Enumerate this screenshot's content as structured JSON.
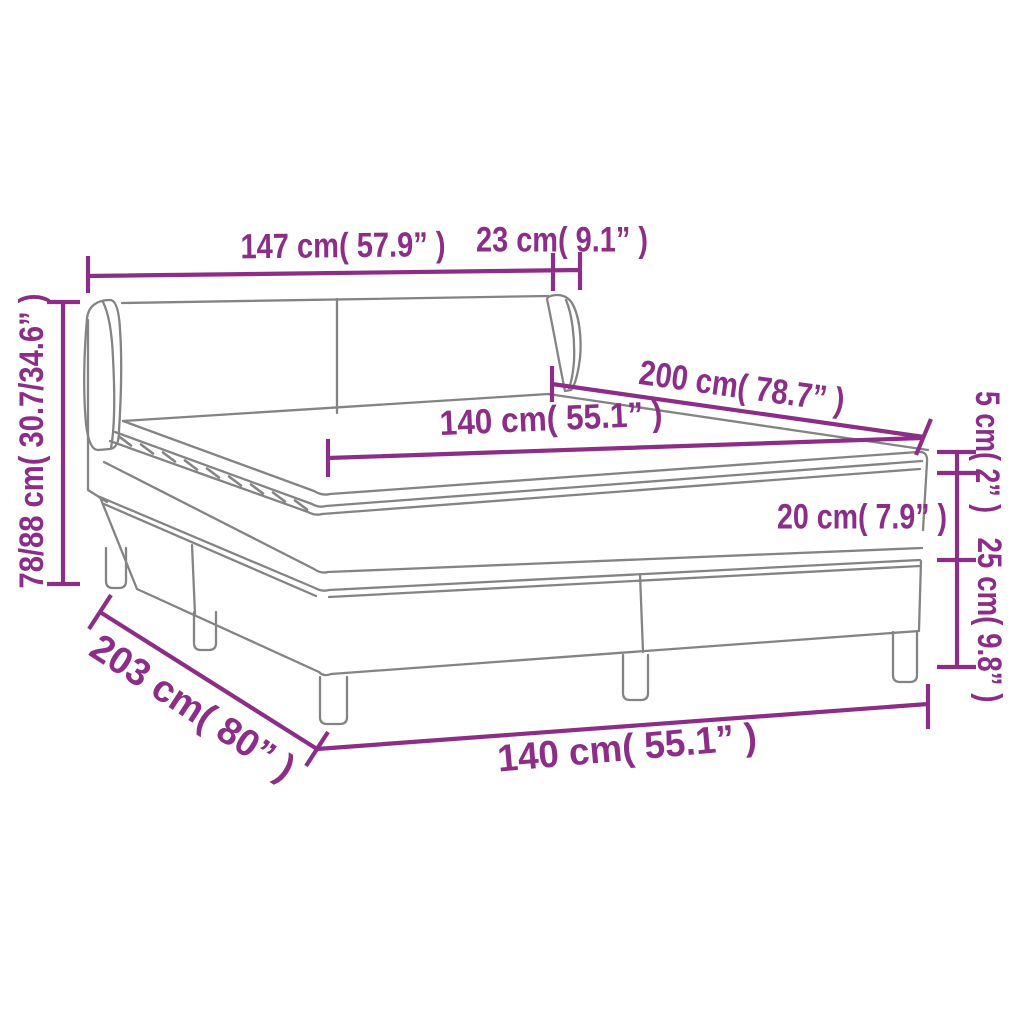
{
  "diagram": {
    "kind": "product dimension diagram",
    "subject": "box spring bed with winged headboard, mattress and topper",
    "colors": {
      "accent": "#8C2E87",
      "drawing_line": "#848484",
      "background": "#FFFFFF"
    },
    "units": {
      "primary": "cm",
      "secondary": "inches"
    }
  },
  "dims": {
    "headboard_width": {
      "label": "147 cm( 57.9” )",
      "value_cm": "147",
      "value_in": "57.9"
    },
    "wing_depth": {
      "label": "23 cm( 9.1” )",
      "value_cm": "23",
      "value_in": "9.1"
    },
    "headboard_height": {
      "label": "78/88 cm( 30.7/34.6” )",
      "value_cm": "78/88",
      "value_in": "30.7/34.6"
    },
    "bed_length": {
      "label": "200 cm( 78.7” )",
      "value_cm": "200",
      "value_in": "78.7"
    },
    "mattress_width": {
      "label": "140 cm( 55.1” )",
      "value_cm": "140",
      "value_in": "55.1"
    },
    "topper_thickness": {
      "label": "5 cm( 2” )",
      "value_cm": "5",
      "value_in": "2"
    },
    "mattress_thickness": {
      "label": "20 cm( 7.9” )",
      "value_cm": "20",
      "value_in": "7.9"
    },
    "base_height": {
      "label": "25 cm( 9.8” )",
      "value_cm": "25",
      "value_in": "9.8"
    },
    "base_length": {
      "label": "203 cm( 80” )",
      "value_cm": "203",
      "value_in": "80"
    },
    "base_width": {
      "label": "140 cm( 55.1” )",
      "value_cm": "140",
      "value_in": "55.1"
    }
  }
}
